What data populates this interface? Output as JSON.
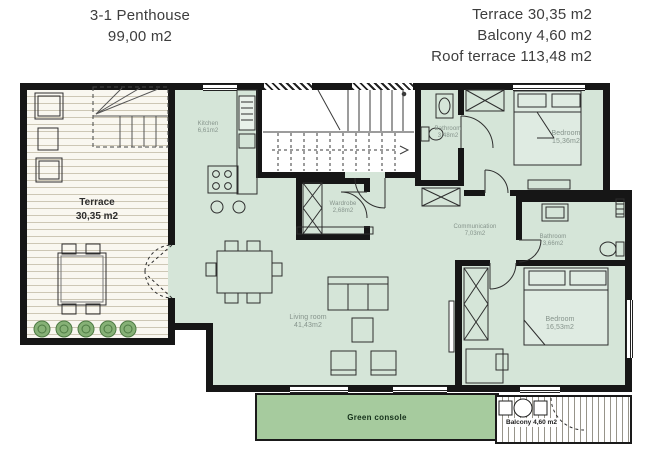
{
  "header": {
    "unit_title": "3-1 Penthouse",
    "unit_area": "99,00 m2",
    "summary": [
      "Terrace 30,35 m2",
      "Balcony 4,60 m2",
      "Roof terrace 113,48 m2"
    ]
  },
  "rooms": {
    "terrace": {
      "name": "Terrace",
      "area": "30,35 m2"
    },
    "kitchen": {
      "name": "Kitchen",
      "area": "6,61m2"
    },
    "bathroom_1": {
      "name": "Bathroom",
      "area": "3,48m2"
    },
    "bedroom_1": {
      "name": "Bedroom",
      "area": "15,36m2"
    },
    "wardrobe": {
      "name": "Wardrobe",
      "area": "2,68m2"
    },
    "communication": {
      "name": "Communication",
      "area": "7,03m2"
    },
    "bathroom_2": {
      "name": "Bathroom",
      "area": "3,66m2"
    },
    "bedroom_2": {
      "name": "Bedroom",
      "area": "16,53m2"
    },
    "living_room": {
      "name": "Living room",
      "area": "41,43m2"
    },
    "green_console": {
      "name": "Green console"
    },
    "balcony": {
      "name": "Balcony 4,60 m2"
    }
  },
  "colors": {
    "floor": "#d5e5d8",
    "console": "#a6cb9e",
    "wall": "#161616",
    "terrace_bg": "#f9f7f0",
    "plank": "#cdc7b5",
    "hatch": "#97948a",
    "plant": "#86b176",
    "label": "#85938b"
  }
}
